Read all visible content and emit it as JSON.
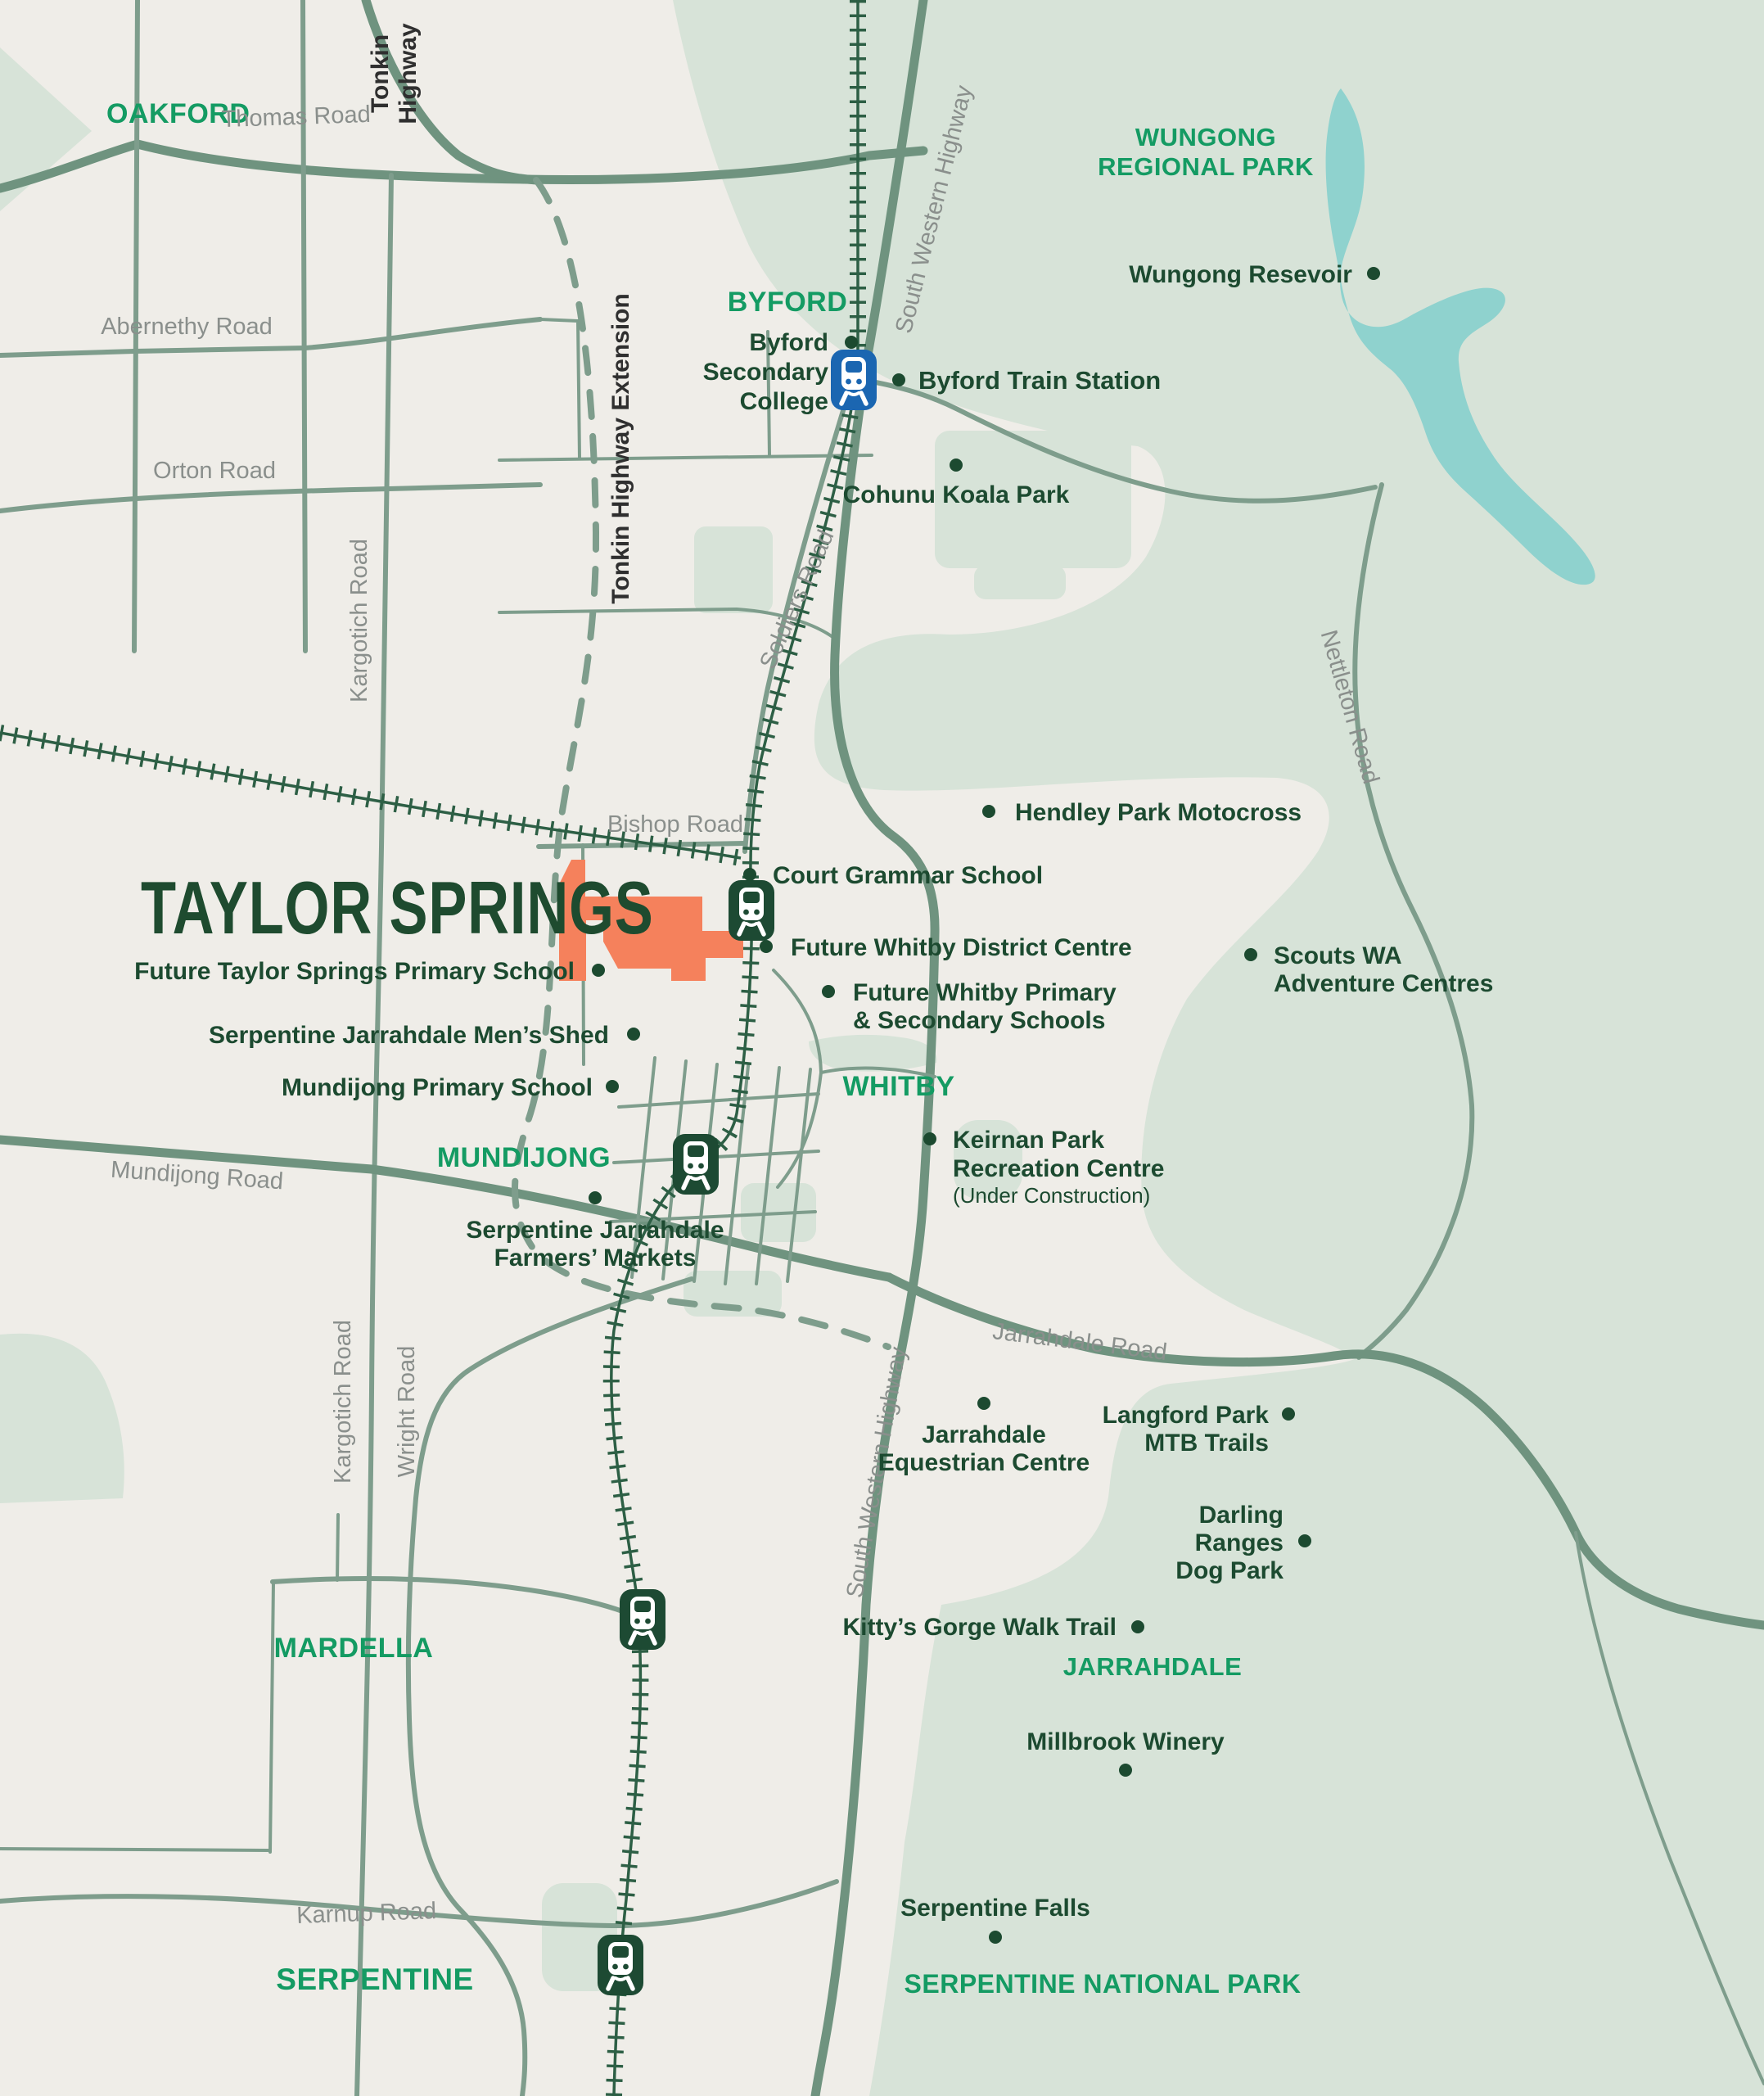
{
  "map": {
    "title": "TAYLOR SPRINGS",
    "colors": {
      "background": "#EFEDE8",
      "park_green": "#D7E3D8",
      "water_teal": "#8FD2CE",
      "road_sage": "#7E9D8C",
      "road_major": "#6F937F",
      "railway_dark_green": "#2D5F45",
      "site_orange": "#F5815C",
      "locality_green": "#149B63",
      "poi_dark_green": "#1C4A30",
      "road_label_gray": "#8A8F8C",
      "highway_label_dark": "#2F2F2F",
      "station_existing_blue": "#1B66B1",
      "station_future_green": "#1D4A33"
    },
    "localities": {
      "oakford": "OAKFORD",
      "byford": "BYFORD",
      "wungong_l1": "WUNGONG",
      "wungong_l2": "REGIONAL PARK",
      "mundijong": "MUNDIJONG",
      "whitby": "WHITBY",
      "mardella": "MARDELLA",
      "jarrahdale": "JARRAHDALE",
      "serpentine": "SERPENTINE",
      "serpentine_np": "SERPENTINE NATIONAL PARK"
    },
    "roads": {
      "thomas": "Thomas Road",
      "abernethy": "Abernethy Road",
      "orton": "Orton Road",
      "kargotich": "Kargotich Road",
      "tonkin_l1": "Tonkin",
      "tonkin_l2": "Highway",
      "tonkin_ext": "Tonkin Highway Extension",
      "south_western_hwy": "South Western Highway",
      "soldiers": "Soldiers Road",
      "bishop": "Bishop Road",
      "nettleton": "Nettleton Road",
      "mundijong_rd": "Mundijong Road",
      "jarrahdale_rd": "Jarrahdale Road",
      "wright": "Wright Road",
      "karnup": "Karnup Road"
    },
    "pois": {
      "byford_college_l1": "Byford",
      "byford_college_l2": "Secondary",
      "byford_college_l3": "College",
      "byford_station": "Byford Train Station",
      "cohunu": "Cohunu Koala Park",
      "wungong_reservoir": "Wungong Resevoir",
      "hendley": "Hendley Park Motocross",
      "court_grammar": "Court Grammar School",
      "whitby_district": "Future Whitby District Centre",
      "whitby_schools_l1": "Future Whitby Primary",
      "whitby_schools_l2": "& Secondary Schools",
      "taylor_primary": "Future Taylor Springs Primary School",
      "mens_shed": "Serpentine Jarrahdale Men’s Shed",
      "mundijong_primary": "Mundijong Primary School",
      "scouts_l1": "Scouts WA",
      "scouts_l2": "Adventure Centres",
      "keirnan_l1": "Keirnan Park",
      "keirnan_l2": "Recreation Centre",
      "keirnan_l3": "(Under Construction)",
      "farmers_l1": "Serpentine Jarrahdale",
      "farmers_l2": "Farmers’ Markets",
      "equestrian_l1": "Jarrahdale",
      "equestrian_l2": "Equestrian Centre",
      "langford_l1": "Langford Park",
      "langford_l2": "MTB Trails",
      "darling_l1": "Darling",
      "darling_l2": "Ranges",
      "darling_l3": "Dog Park",
      "kittys": "Kitty’s Gorge Walk Trail",
      "millbrook": "Millbrook Winery",
      "serpentine_falls": "Serpentine Falls"
    },
    "stations": {
      "byford": "existing",
      "whitby": "future",
      "mundijong": "future",
      "mardella": "future",
      "serpentine": "future"
    }
  }
}
